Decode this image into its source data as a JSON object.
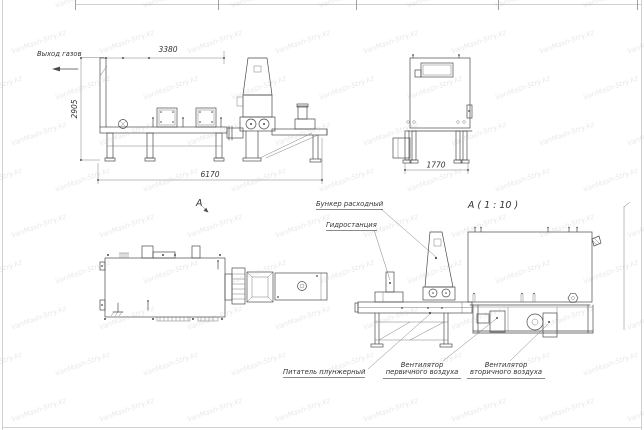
{
  "watermark": {
    "text": "VanMash-Stry.kz"
  },
  "colors": {
    "line": "#4a4a4a",
    "dim_text": "#333333",
    "watermark": "#9ca8b1",
    "border": "#ccd1d4"
  },
  "side_view": {
    "gas_outlet_label": "Выход газов",
    "dim_width_top": "3380",
    "dim_height": "2905",
    "dim_length": "6170"
  },
  "end_view": {
    "dim_width": "1770"
  },
  "plan_view": {
    "view_label": "А"
  },
  "detail_view": {
    "title": "А ( 1 : 10 )",
    "callout_feed_hopper": "Бункер расходный",
    "callout_hydraulic_station": "Гидростанция",
    "callout_plunger_feeder": "Питатель плунжерный",
    "callout_primary_air_fan": "Вентилятор\nпервичного воздуха",
    "callout_secondary_air_fan": "Вентилятор\nвторичного воздуха"
  }
}
